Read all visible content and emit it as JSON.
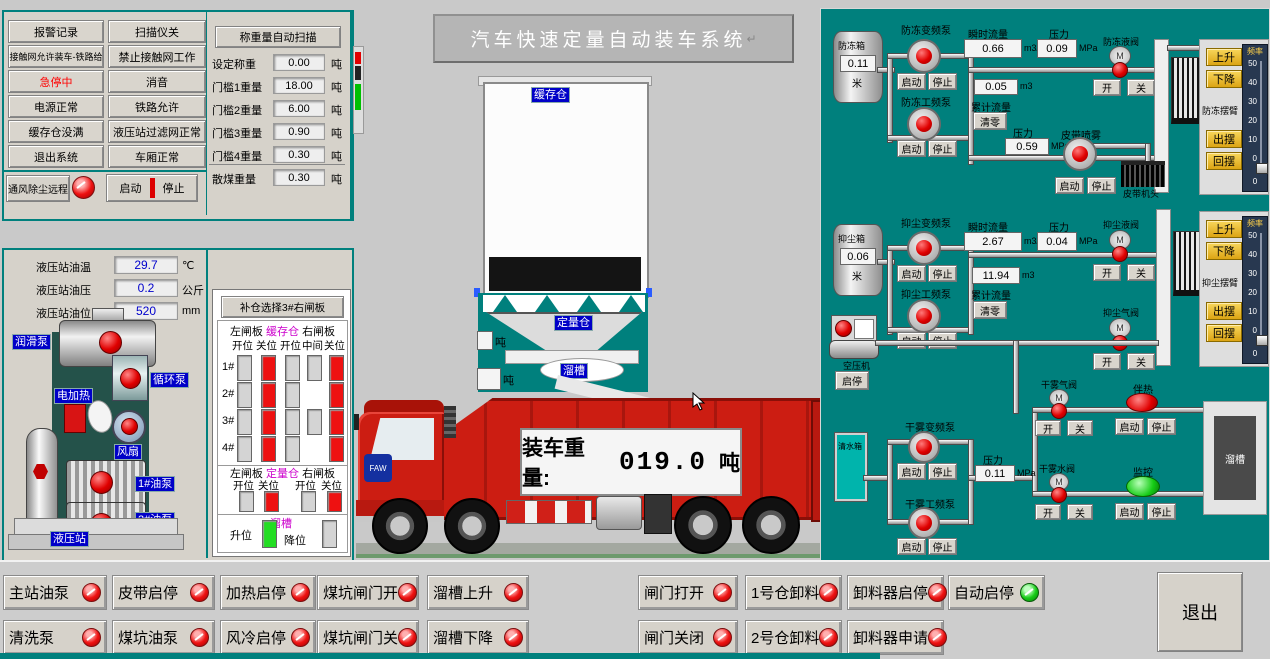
{
  "colors": {
    "teal_bg": "#00807d",
    "indicator_red": "#e00000",
    "indicator_green": "#17cc17",
    "magenta": "#cc00cc",
    "label_blue": "#0000c8",
    "truck_red": "#cc1d12",
    "yellow_button": "#e9b81f",
    "alarm_text": "#ff0000"
  },
  "status_panel": {
    "col1": [
      {
        "label": "报警记录"
      },
      {
        "label": "接触网允许装车-铁路给"
      },
      {
        "label": "急停中",
        "alarm": true
      },
      {
        "label": "电源正常"
      },
      {
        "label": "缓存仓没满"
      },
      {
        "label": "退出系统"
      }
    ],
    "col2": [
      {
        "label": "扫描仪关"
      },
      {
        "label": "禁止接触网工作"
      },
      {
        "label": "消音"
      },
      {
        "label": "铁路允许"
      },
      {
        "label": "液压站过滤网正常"
      },
      {
        "label": "车厢正常"
      }
    ],
    "vent": {
      "label": "通风除尘远程",
      "start": "启动",
      "stop": "停止"
    }
  },
  "weigh_panel": {
    "title": "称重量自动扫描",
    "rows": [
      {
        "label": "设定称重",
        "value": "0.00",
        "unit": "吨"
      },
      {
        "label": "门槛1重量",
        "value": "18.00",
        "unit": "吨"
      },
      {
        "label": "门槛2重量",
        "value": "6.00",
        "unit": "吨"
      },
      {
        "label": "门槛3重量",
        "value": "0.90",
        "unit": "吨"
      },
      {
        "label": "门槛4重量",
        "value": "0.30",
        "unit": "吨"
      },
      {
        "label": "散煤重量",
        "value": "0.30",
        "unit": "吨"
      }
    ]
  },
  "hydraulic": {
    "rows": [
      {
        "label": "液压站油温",
        "value": "29.7",
        "unit": "℃"
      },
      {
        "label": "液压站油压",
        "value": "0.2",
        "unit": "公斤"
      },
      {
        "label": "液压站油位",
        "value": "520",
        "unit": "mm"
      }
    ],
    "labels": {
      "lube_pump": "润滑泵",
      "circ_pump": "循环泵",
      "heater": "电加热",
      "fan": "风扇",
      "oil_pump1": "1#油泵",
      "oil_pump2": "2#油泵",
      "station": "液压站"
    }
  },
  "gate_panel": {
    "title": "补仓选择3#右闸板",
    "buffer": {
      "left": "左闸板",
      "center": "缓存仓",
      "right": "右闸板",
      "columns": [
        "开位",
        "关位",
        "开位",
        "中间",
        "关位"
      ],
      "rows": [
        {
          "label": "1#",
          "cells": [
            "off",
            "on",
            "off",
            "off",
            "on"
          ]
        },
        {
          "label": "2#",
          "cells": [
            "off",
            "on",
            "off",
            "none",
            "on"
          ]
        },
        {
          "label": "3#",
          "cells": [
            "off",
            "on",
            "off",
            "off",
            "on"
          ]
        },
        {
          "label": "4#",
          "cells": [
            "off",
            "on",
            "off",
            "none",
            "on"
          ]
        }
      ]
    },
    "weigh": {
      "left": "左闸板",
      "center": "定量仓",
      "right": "右闸板",
      "columns": [
        "开位",
        "关位",
        "开位",
        "关位"
      ],
      "cells": [
        "off",
        "on",
        "off",
        "on"
      ]
    },
    "chute": {
      "label": "溜槽",
      "up": "升位",
      "down": "降位",
      "up_state": "green",
      "down_state": "off"
    }
  },
  "center": {
    "title": "汽车快速定量自动装车系统",
    "return_mark": "↵",
    "buffer_bin": "缓存仓",
    "weigh_bin": "定量仓",
    "chute": "溜槽",
    "ton_a": "吨",
    "ton_b": "吨",
    "truck": {
      "label": "装车重量:",
      "value": "019.0",
      "unit": "吨",
      "brand": "FAW"
    }
  },
  "right": {
    "m_label": "M",
    "antifreeze": {
      "tank": "防冻箱",
      "level": "0.11",
      "level_unit": "米",
      "pump_vfd": "防冻变频泵",
      "pump_lf": "防冻工频泵",
      "start": "启动",
      "stop": "停止",
      "start2": "启动",
      "stop2": "停止",
      "flow_label": "瞬时流量",
      "flow": "0.66",
      "flow_unit": "m3/h",
      "press_label": "压力",
      "press": "0.09",
      "press_unit": "MPa",
      "total": "0.05",
      "total_unit": "m3",
      "total_label": "累计流量",
      "clear": "清零",
      "press2_label": "压力",
      "press2": "0.59",
      "press2_unit": "MPa",
      "valve": "防冻液阀",
      "valve_open": "开",
      "valve_close": "关",
      "arm": {
        "up": "上升",
        "down": "下降",
        "freq": "频率",
        "name": "防冻摆臂",
        "out": "出摆",
        "back": "回摆",
        "value": "0",
        "ticks": [
          "50",
          "40",
          "30",
          "20",
          "10",
          "0"
        ]
      }
    },
    "belt": {
      "spray": "皮带喷雾",
      "start": "启动",
      "stop": "停止",
      "head": "皮带机头"
    },
    "dust": {
      "tank": "抑尘箱",
      "level": "0.06",
      "level_unit": "米",
      "pump_vfd": "抑尘变频泵",
      "pump_lf": "抑尘工频泵",
      "start": "启动",
      "stop": "停止",
      "start2": "启动",
      "stop2": "停止",
      "flow_label": "瞬时流量",
      "flow": "2.67",
      "flow_unit": "m3/h",
      "press_label": "压力",
      "press": "0.04",
      "press_unit": "MPa",
      "total": "11.94",
      "total_unit": "m3",
      "total_label": "累计流量",
      "clear": "清零",
      "valve_liquid": "抑尘液阀",
      "lv_open": "开",
      "lv_close": "关",
      "valve_air": "抑尘气阀",
      "av_open": "开",
      "av_close": "关",
      "arm": {
        "up": "上升",
        "down": "下降",
        "freq": "频率",
        "name": "抑尘摆臂",
        "out": "出摆",
        "back": "回摆",
        "value": "0",
        "ticks": [
          "50",
          "40",
          "30",
          "20",
          "10",
          "0"
        ]
      }
    },
    "compressor": {
      "label": "空压机",
      "btn": "启停"
    },
    "fog": {
      "tank": "清水箱",
      "pump_vfd": "干雾变频泵",
      "pump_lf": "干雾工频泵",
      "start": "启动",
      "stop": "停止",
      "start2": "启动",
      "stop2": "停止",
      "press_label": "压力",
      "press": "0.11",
      "press_unit": "MPa",
      "valve_air": "干雾气阀",
      "av_open": "开",
      "av_close": "关",
      "valve_water": "干雾水阀",
      "wv_open": "开",
      "wv_close": "关",
      "heat": {
        "label": "伴热",
        "start": "启动",
        "stop": "停止"
      },
      "monitor": {
        "label": "监控",
        "start": "启动",
        "stop": "停止"
      },
      "chute": "溜槽"
    }
  },
  "bottom": {
    "row1": [
      {
        "label": "主站油泵",
        "state": "red"
      },
      {
        "label": "皮带启停",
        "state": "red"
      },
      {
        "label": "加热启停",
        "state": "red"
      },
      {
        "label": "煤坑闸门开",
        "state": "red"
      },
      {
        "label": "溜槽上升",
        "state": "red"
      },
      {
        "label": "闸门打开",
        "state": "red"
      },
      {
        "label": "1号仓卸料",
        "state": "red"
      },
      {
        "label": "卸料器启停",
        "state": "red"
      },
      {
        "label": "自动启停",
        "state": "green"
      }
    ],
    "row2": [
      {
        "label": "清洗泵",
        "state": "red"
      },
      {
        "label": "煤坑油泵",
        "state": "red"
      },
      {
        "label": "风冷启停",
        "state": "red"
      },
      {
        "label": "煤坑闸门关",
        "state": "red"
      },
      {
        "label": "溜槽下降",
        "state": "red"
      },
      {
        "label": "闸门关闭",
        "state": "red"
      },
      {
        "label": "2号仓卸料",
        "state": "red"
      },
      {
        "label": "卸料器申请",
        "state": "red"
      }
    ],
    "exit": "退出"
  }
}
